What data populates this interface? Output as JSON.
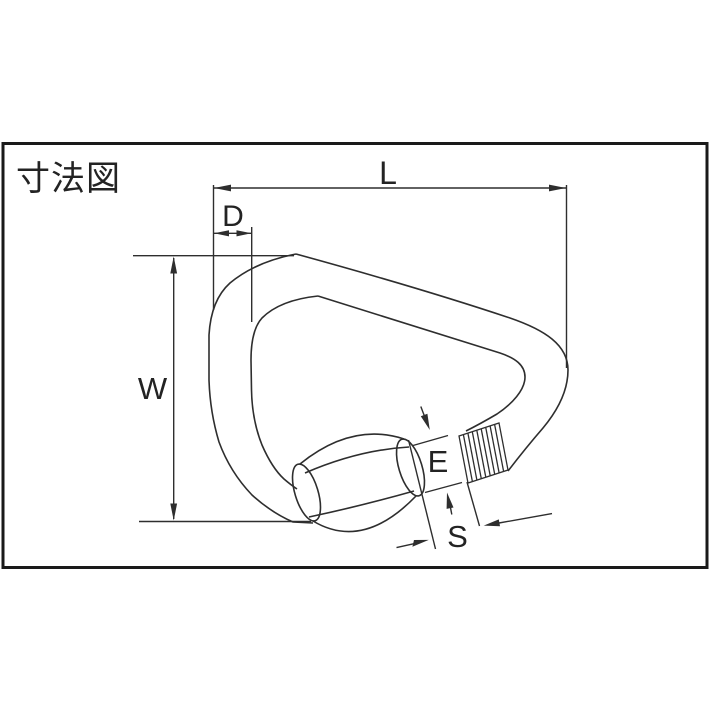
{
  "title": "寸法図",
  "diagram": {
    "subject": "screw-lock delta quick link dimension drawing",
    "dimensions": {
      "length_label": "L",
      "diameter_label": "D",
      "width_label": "W",
      "opening_label": "E",
      "screw_label": "S"
    }
  },
  "colors": {
    "ink": "#2e2e2e",
    "border": "#1a1a1a",
    "background": "#ffffff"
  }
}
